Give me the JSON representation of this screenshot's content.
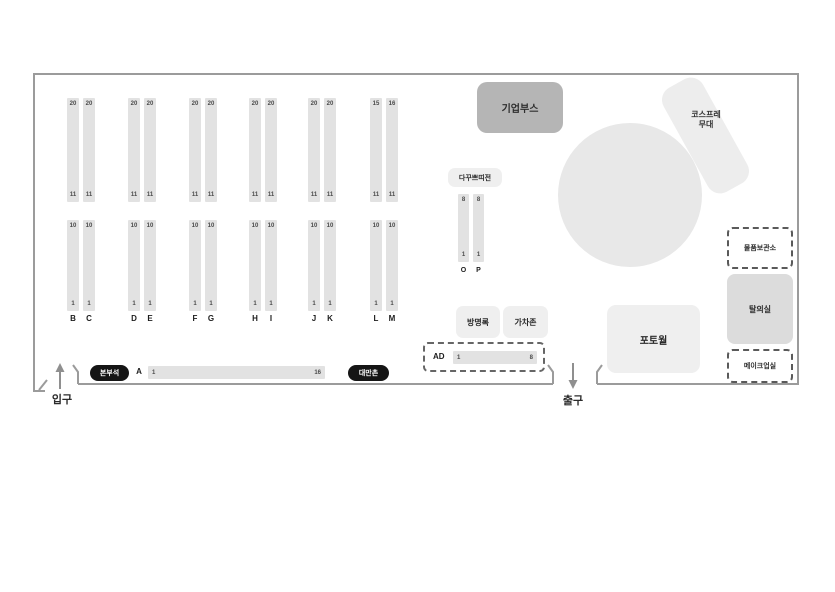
{
  "map": {
    "entrance": {
      "label": "입구"
    },
    "exit": {
      "label": "출구"
    },
    "booth_columns": [
      {
        "letter": "B",
        "top_first": "20",
        "top_last": "11",
        "bottom_first": "10",
        "bottom_last": "1"
      },
      {
        "letter": "C",
        "top_first": "20",
        "top_last": "11",
        "bottom_first": "10",
        "bottom_last": "1"
      },
      {
        "letter": "D",
        "top_first": "20",
        "top_last": "11",
        "bottom_first": "10",
        "bottom_last": "1"
      },
      {
        "letter": "E",
        "top_first": "20",
        "top_last": "11",
        "bottom_first": "10",
        "bottom_last": "1"
      },
      {
        "letter": "F",
        "top_first": "20",
        "top_last": "11",
        "bottom_first": "10",
        "bottom_last": "1"
      },
      {
        "letter": "G",
        "top_first": "20",
        "top_last": "11",
        "bottom_first": "10",
        "bottom_last": "1"
      },
      {
        "letter": "H",
        "top_first": "20",
        "top_last": "11",
        "bottom_first": "10",
        "bottom_last": "1"
      },
      {
        "letter": "I",
        "top_first": "20",
        "top_last": "11",
        "bottom_first": "10",
        "bottom_last": "1"
      },
      {
        "letter": "J",
        "top_first": "20",
        "top_last": "11",
        "bottom_first": "10",
        "bottom_last": "1"
      },
      {
        "letter": "K",
        "top_first": "20",
        "top_last": "11",
        "bottom_first": "10",
        "bottom_last": "1"
      },
      {
        "letter": "L",
        "top_first": "15",
        "top_last": "11",
        "bottom_first": "10",
        "bottom_last": "1"
      },
      {
        "letter": "M",
        "top_first": "16",
        "top_last": "11",
        "bottom_first": "10",
        "bottom_last": "1"
      }
    ],
    "corporate_booth": {
      "label": "기업부스"
    },
    "cosplay_stage": {
      "label_line1": "코스프레",
      "label_line2": "무대"
    },
    "dakku_section": {
      "label": "다꾸쁘띠전",
      "columns": [
        {
          "letter": "O",
          "first": "8",
          "last": "1"
        },
        {
          "letter": "P",
          "first": "8",
          "last": "1"
        }
      ]
    },
    "storage": {
      "label": "물품보관소"
    },
    "changing_room": {
      "label": "탈의실"
    },
    "makeup_room": {
      "label": "메이크업실"
    },
    "guestbook": {
      "label": "방명록"
    },
    "gacha_zone": {
      "label": "가차존"
    },
    "photo_wall": {
      "label": "포토월"
    },
    "ad_row": {
      "label": "AD",
      "first": "1",
      "last": "8"
    },
    "hq_badge": {
      "label": "본부석"
    },
    "row_a": {
      "letter": "A",
      "first": "1",
      "last": "16"
    },
    "taiwan_badge": {
      "label": "대만촌"
    },
    "colors": {
      "wall": "#9b9b9b",
      "booth_strip": "#e2e2e2",
      "corporate_booth": "#b5b5b5",
      "stage": "#ededed",
      "circle_area": "#e8e8e8",
      "changing_room": "#dcdcdc",
      "label_box": "#efefef",
      "badge": "#151515"
    }
  }
}
